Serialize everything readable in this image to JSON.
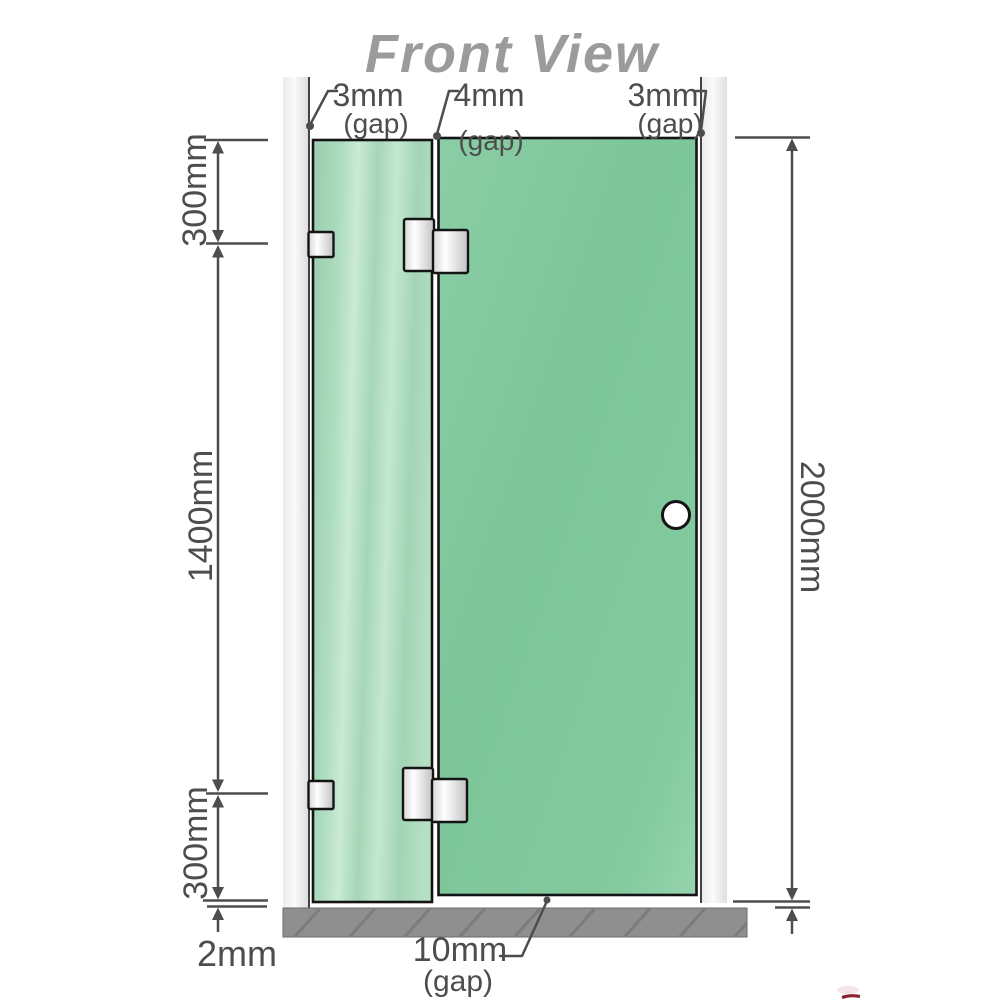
{
  "title": "Front View",
  "annotations": {
    "top_left_gap": {
      "value": "3mm",
      "qualifier": "(gap)"
    },
    "top_middle_gap": {
      "value": "4mm",
      "qualifier": "(gap)"
    },
    "top_right_gap": {
      "value": "3mm",
      "qualifier": "(gap)"
    },
    "bottom_gap": {
      "value": "10mm",
      "qualifier": "(gap)"
    },
    "upper_left_dim": "300mm",
    "middle_left_dim": "1400mm",
    "lower_left_dim": "300mm",
    "floor_clearance_dim": "2mm",
    "overall_height_dim": "2000mm"
  },
  "colors": {
    "title_text": "#9b9b9b",
    "dimension_text": "#4d4d4d",
    "dimension_line": "#4d4d4d",
    "fixed_panel_glass": "#a6d7b8",
    "door_panel_glass": "#80c89e",
    "wall_channel": "#ebebeb",
    "floor_base": "#8f8f8f",
    "hardware_metal": "#e6e6e6",
    "outline": "#141414",
    "logo_mark_red": "#8b2030"
  }
}
